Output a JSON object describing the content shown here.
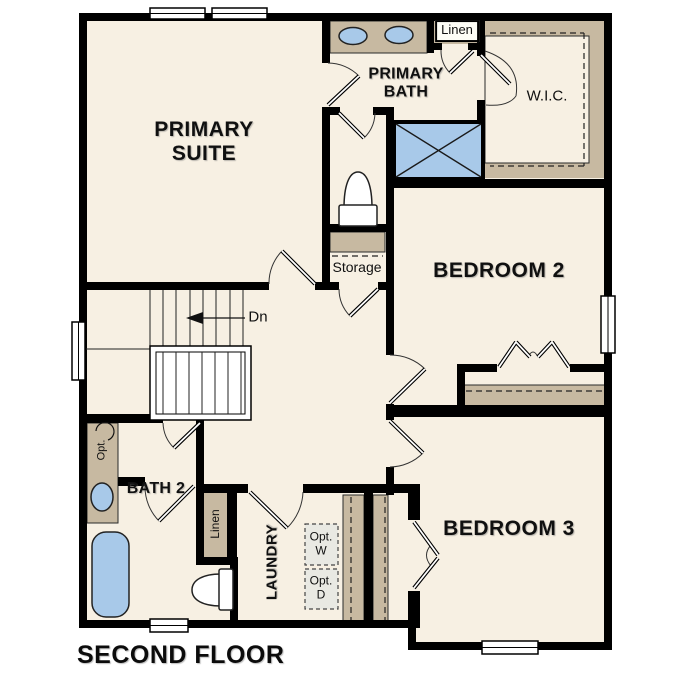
{
  "plan": {
    "title": "SECOND FLOOR",
    "rooms": {
      "primary_suite": "PRIMARY SUITE",
      "primary_bath": "PRIMARY BATH",
      "wic": "W.I.C.",
      "bedroom2": "BEDROOM 2",
      "bedroom3": "BEDROOM 3",
      "bath2": "BATH 2",
      "laundry": "LAUNDRY",
      "storage": "Storage"
    },
    "closets": {
      "linen_upper": "Linen",
      "linen_lower": "Linen"
    },
    "annotations": {
      "stairs_down": "Dn",
      "optional_washer": "Opt. W",
      "optional_dryer": "Opt. D",
      "optional_vanity": "Opt."
    },
    "colors": {
      "floor": "#f7f0e3",
      "casework": "#c7b9a1",
      "fixture_blue": "#a8c9e9",
      "optional_fill": "#e9e9e3",
      "wall": "#000000"
    }
  }
}
